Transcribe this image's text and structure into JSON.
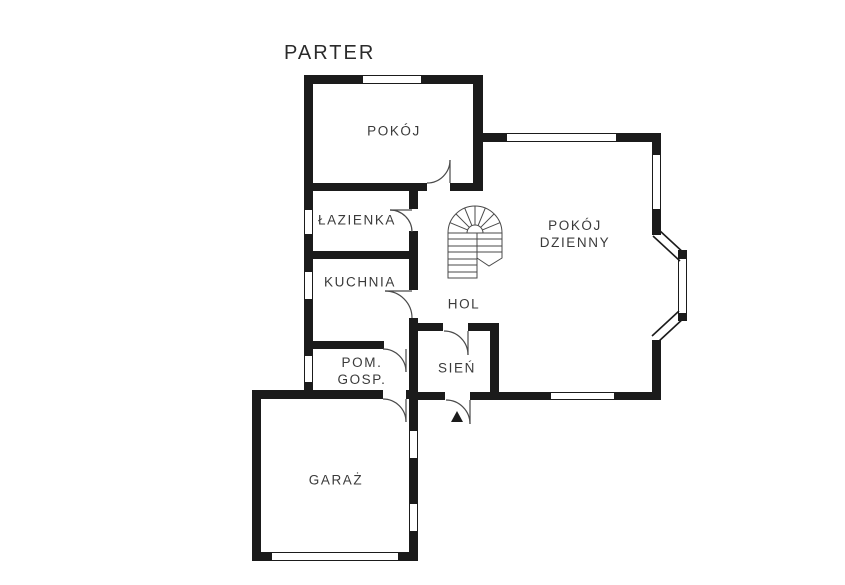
{
  "title": "PARTER",
  "colors": {
    "wall": "#1b1b1b",
    "text": "#3a3a3a",
    "background": "#ffffff"
  },
  "rooms": {
    "pokoj": {
      "label": "POKÓJ"
    },
    "lazienka": {
      "label": "ŁAZIENKA"
    },
    "kuchnia": {
      "label": "KUCHNIA"
    },
    "pom_gosp": {
      "line1": "POM.",
      "line2": "GOSP."
    },
    "sien": {
      "label": "SIEŃ"
    },
    "hol": {
      "label": "HOL"
    },
    "pokoj_dzienny": {
      "line1": "POKÓJ",
      "line2": "DZIENNY"
    },
    "garaz": {
      "label": "GARAŻ"
    }
  }
}
